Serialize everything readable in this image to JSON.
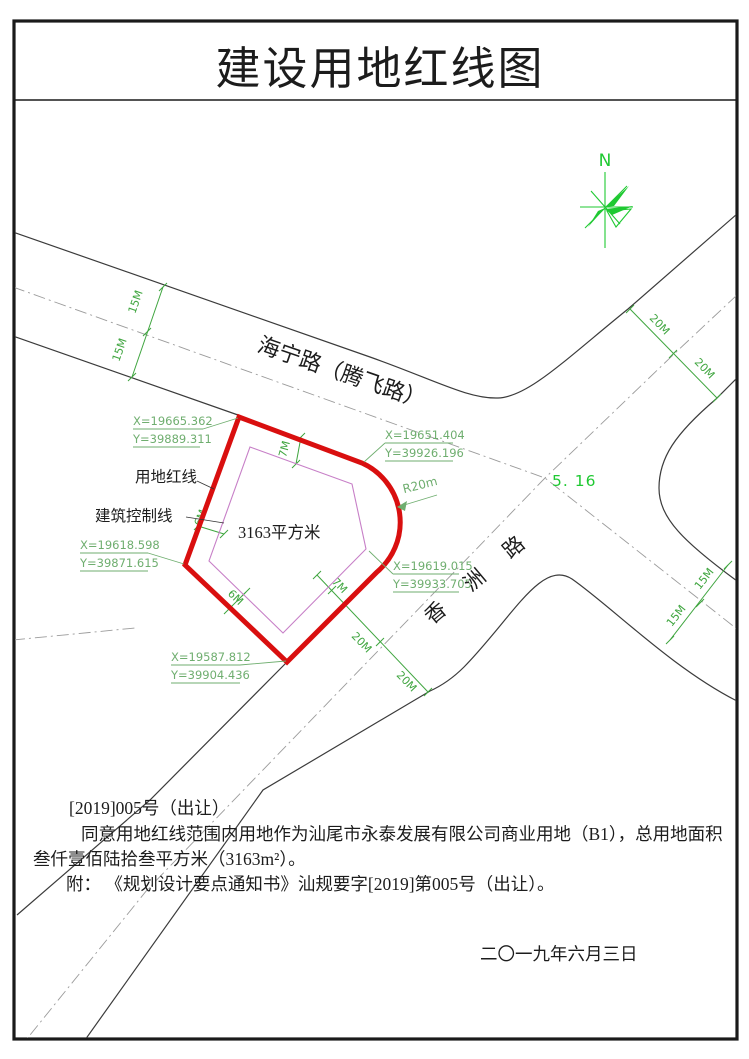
{
  "title": "建设用地红线图",
  "north_label": "N",
  "roads": {
    "haining": "海宁路（腾飞路）",
    "xiangzhou": "香洲路"
  },
  "site": {
    "red_line_label": "用地红线",
    "control_line_label": "建筑控制线",
    "area_label": "3163平方米",
    "radius_label": "R20m",
    "spot_elevation": "5. 16",
    "coords": [
      {
        "x": "X=19665.362",
        "y": "Y=39889.311"
      },
      {
        "x": "X=19651.404",
        "y": "Y=39926.196"
      },
      {
        "x": "X=19618.598",
        "y": "Y=39871.615"
      },
      {
        "x": "X=19619.015",
        "y": "Y=39933.705"
      },
      {
        "x": "X=19587.812",
        "y": "Y=39904.436"
      }
    ]
  },
  "dims": {
    "haining_west": [
      "15M",
      "15M"
    ],
    "xiangzhou_ne": [
      "20M",
      "20M"
    ],
    "xiangzhou_sw": [
      "20M",
      "20M"
    ],
    "east_branch": [
      "15M",
      "15M"
    ],
    "setbacks": {
      "top": "7M",
      "left": "6M",
      "bottom_left": "6M",
      "bottom_right": "7M"
    }
  },
  "notes": {
    "line1": "[2019]005号（出让）",
    "line2": "同意用地红线范围内用地作为汕尾市永泰发展有限公司商业用地（B1），总用地面积",
    "line3": "叁仟壹佰陆拾叁平方米（3163m²）。",
    "line4": "附： 《规划设计要点通知书》汕规要字[2019]第005号（出让）。",
    "date": "二〇一九年六月三日"
  },
  "colors": {
    "red_line": "#d90f0f",
    "control_line": "#c77fc7",
    "annotation_green": "#6fae6f",
    "dimension_green": "#3fa53f",
    "bright_green": "#1fc932"
  }
}
